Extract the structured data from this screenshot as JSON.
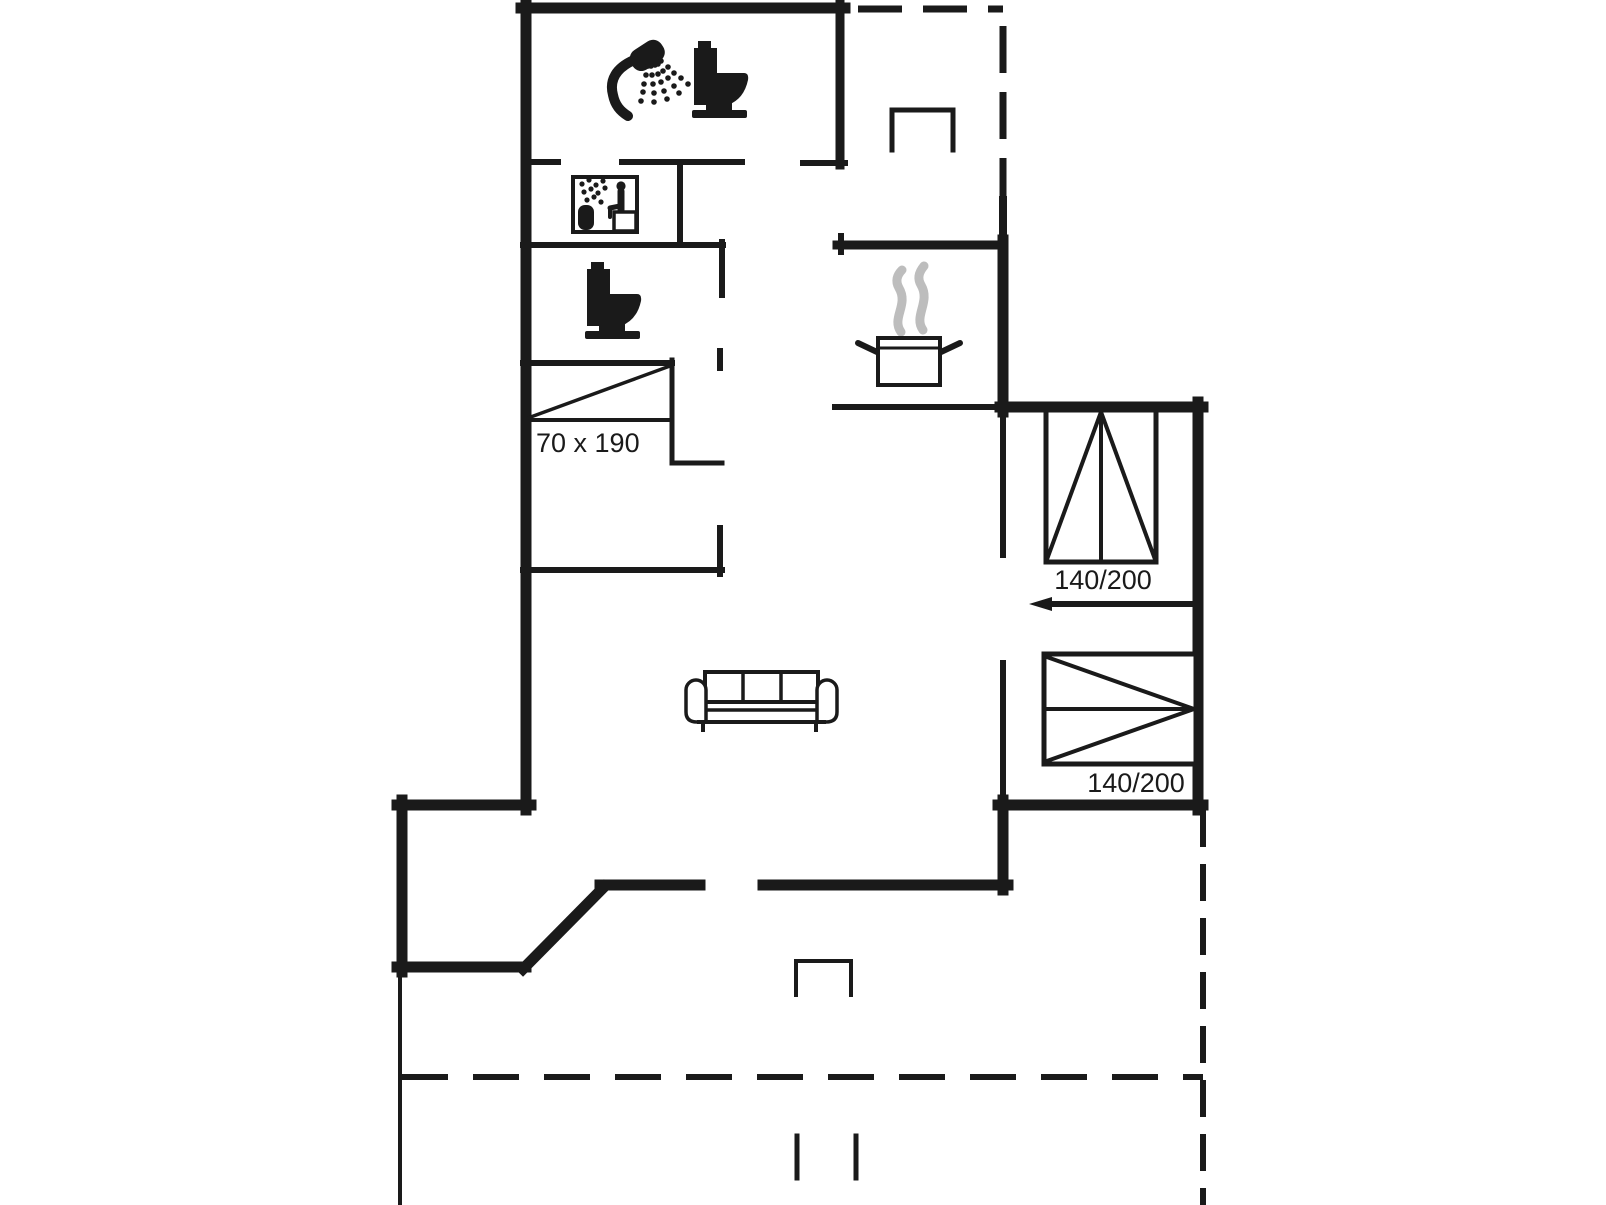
{
  "document": {
    "type": "holiday-home-floor-plan",
    "background": "#ffffff"
  },
  "palette": {
    "ink": "#1a1a1a",
    "steam": "#bdbdbd",
    "background": "#ffffff"
  },
  "furniture": [
    {
      "name": "single-bed",
      "size_label": "70 x 190"
    },
    {
      "name": "double-bed-upper",
      "size_label": "140/200"
    },
    {
      "name": "double-bed-lower",
      "size_label": "140/200"
    },
    {
      "name": "sofa",
      "seats": 3
    }
  ],
  "icons": [
    "shower-icon",
    "toilet-icon-bathroom",
    "sauna-icon",
    "toilet-icon-wc",
    "cooking-pot-icon",
    "sofa-icon",
    "single-bed-symbol",
    "double-bed-upper-symbol",
    "double-bed-lower-symbol",
    "entry-step-top",
    "entry-step-bottom",
    "terrace-step-marks",
    "door-direction-arrow"
  ],
  "outline": {
    "solid_walls": "rooms",
    "dashed_lines": "covered terrace / annex outline"
  }
}
